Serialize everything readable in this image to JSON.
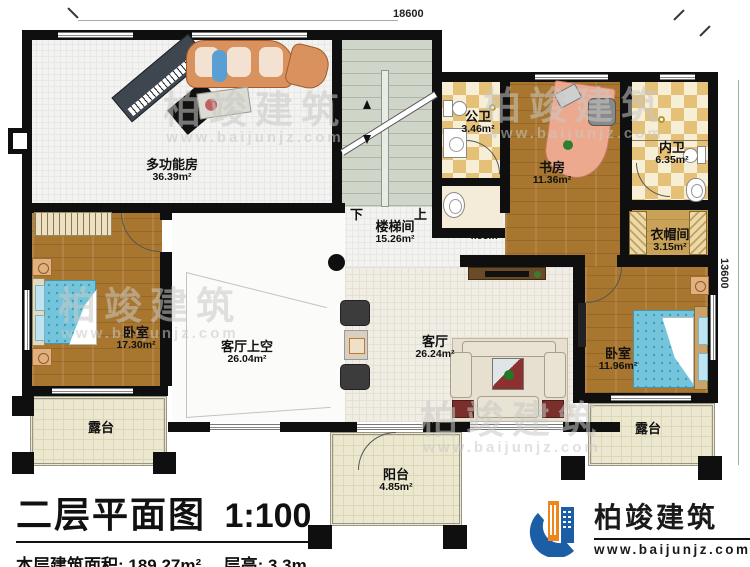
{
  "dimensions": {
    "top": "18600",
    "right": "13600"
  },
  "stair": {
    "down": "下",
    "up": "上"
  },
  "rooms": {
    "multifunction": {
      "name": "多功能房",
      "area": "36.39m²"
    },
    "stairwell": {
      "name": "楼梯间",
      "area": "15.26m²"
    },
    "public_bath": {
      "name": "公卫",
      "area": "3.46m²"
    },
    "basin": {
      "area": "2.08m²"
    },
    "study": {
      "name": "书房",
      "area": "11.36m²"
    },
    "inner_bath": {
      "name": "内卫",
      "area": "6.35m²"
    },
    "cloakroom": {
      "name": "衣帽间",
      "area": "3.15m²"
    },
    "corridor": {
      "area": "4.55m²"
    },
    "bedroom_left": {
      "name": "卧室",
      "area": "17.30m²"
    },
    "void": {
      "name": "客厅上空",
      "area": "26.04m²"
    },
    "living": {
      "name": "客厅",
      "area": "26.24m²"
    },
    "bedroom_right": {
      "name": "卧室",
      "area": "11.96m²"
    },
    "terrace_left": {
      "name": "露台"
    },
    "terrace_right": {
      "name": "露台"
    },
    "balcony": {
      "name": "阳台",
      "area": "4.85m²"
    }
  },
  "title": {
    "main": "二层平面图",
    "scale": "1:100"
  },
  "info": {
    "area": "本层建筑面积: 189.27m²",
    "height": "层高: 3.3m"
  },
  "logo": {
    "name": "柏竣建筑",
    "url": "www.baijunjz.com"
  },
  "watermark": {
    "text": "柏竣建筑",
    "url": "www.baijunjz.com"
  },
  "colors": {
    "wall": "#0f0f0f",
    "logo_blue": "#1b5ea6",
    "logo_orange": "#f08519"
  }
}
